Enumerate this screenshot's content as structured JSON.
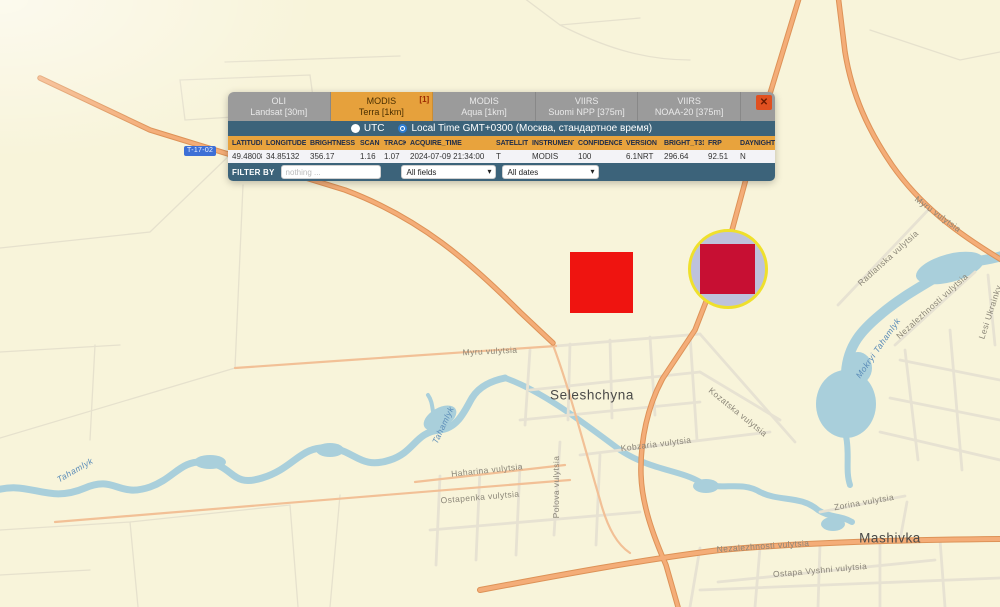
{
  "popup": {
    "tabs": [
      {
        "line1": "OLI",
        "line2": "Landsat [30m]",
        "active": false,
        "badge": ""
      },
      {
        "line1": "MODIS",
        "line2": "Terra [1km]",
        "active": true,
        "badge": "[1]"
      },
      {
        "line1": "MODIS",
        "line2": "Aqua [1km]",
        "active": false,
        "badge": ""
      },
      {
        "line1": "VIIRS",
        "line2": "Suomi NPP [375m]",
        "active": false,
        "badge": ""
      },
      {
        "line1": "VIIRS",
        "line2": "NOAA-20 [375m]",
        "active": false,
        "badge": ""
      }
    ],
    "close_icon": "✕",
    "time_options": [
      {
        "label": "UTC",
        "selected": false
      },
      {
        "label": "Local Time GMT+0300 (Москва, стандартное время)",
        "selected": true
      }
    ],
    "table": {
      "columns": [
        "LATITUDE",
        "LONGITUDE",
        "BRIGHTNESS",
        "SCAN",
        "TRACK",
        "ACQUIRE_TIME",
        "SATELLITE",
        "INSTRUMENT",
        "CONFIDENCE",
        "VERSION",
        "BRIGHT_T31",
        "FRP",
        "DAYNIGHT"
      ],
      "rows": [
        [
          "49.48008",
          "34.85132",
          "356.17",
          "1.16",
          "1.07",
          "2024-07-09 21:34:00",
          "T",
          "MODIS",
          "100",
          "6.1NRT",
          "296.64",
          "92.51",
          "N"
        ]
      ]
    },
    "filter": {
      "label": "FILTER BY",
      "placeholder": "nothing ...",
      "field_select": "All fields",
      "date_select": "All dates"
    }
  },
  "map": {
    "pass_tag": "T-17-02",
    "labels": [
      {
        "text": "Myru vulytsia",
        "type": "street"
      },
      {
        "text": "Myru vulytsia",
        "type": "street"
      },
      {
        "text": "Radianska vulytsia",
        "type": "street"
      },
      {
        "text": "Nezalezhnosti vulytsia",
        "type": "street"
      },
      {
        "text": "Lesi Ukrainky",
        "type": "street"
      },
      {
        "text": "Mokryi Tahamlyk",
        "type": "water"
      },
      {
        "text": "Seleshchyna",
        "type": "town"
      },
      {
        "text": "Kozatska vulytsia",
        "type": "street"
      },
      {
        "text": "Kobzaria vulytsia",
        "type": "street"
      },
      {
        "text": "Haharina vulytsia",
        "type": "street"
      },
      {
        "text": "Polova vulytsia",
        "type": "street"
      },
      {
        "text": "Ostapenka vulytsia",
        "type": "street"
      },
      {
        "text": "Tahamlyk",
        "type": "water"
      },
      {
        "text": "Tahamlyk",
        "type": "water"
      },
      {
        "text": "Zorina vulytsia",
        "type": "street"
      },
      {
        "text": "Nezalezhnosti vulytsia",
        "type": "street"
      },
      {
        "text": "Mashivka",
        "type": "town"
      },
      {
        "text": "Ostapa Vyshni vulytsia",
        "type": "street"
      }
    ]
  },
  "markers": {
    "fire_color": "#ef1410",
    "selected_fire_color": "#c70f33",
    "selection_ring_color": "#efe02c",
    "selection_circle_color": "#bec2dc"
  },
  "colors": {
    "accent_orange": "#e8a33d",
    "panel_blue": "#3c637a",
    "map_background": "#f8f4da",
    "water": "#a9cfdb",
    "main_road": "#f4ad78"
  }
}
